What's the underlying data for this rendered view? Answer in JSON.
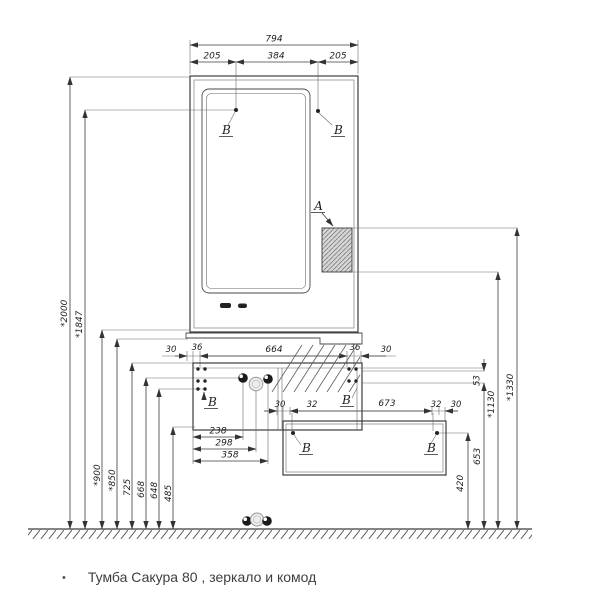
{
  "caption": {
    "bullet": "•",
    "text": "Тумба Сакура 80 , зеркало и комод"
  },
  "labels": {
    "detail_a": "А",
    "detail_b": "В"
  },
  "dims": {
    "top": {
      "total": "794",
      "left": "205",
      "center": "384",
      "right": "205"
    },
    "heights_left": [
      "*2000",
      "*1847",
      "*900",
      "*850",
      "725",
      "668",
      "648",
      "485"
    ],
    "console_row": [
      "30",
      "36",
      "664",
      "36",
      "30"
    ],
    "gap": "53",
    "heights_right": [
      "420",
      "653",
      "*1130",
      "*1330"
    ],
    "vanity_row": [
      "238",
      "298",
      "358"
    ],
    "dresser_row": [
      "30",
      "32",
      "673",
      "32",
      "30"
    ]
  }
}
